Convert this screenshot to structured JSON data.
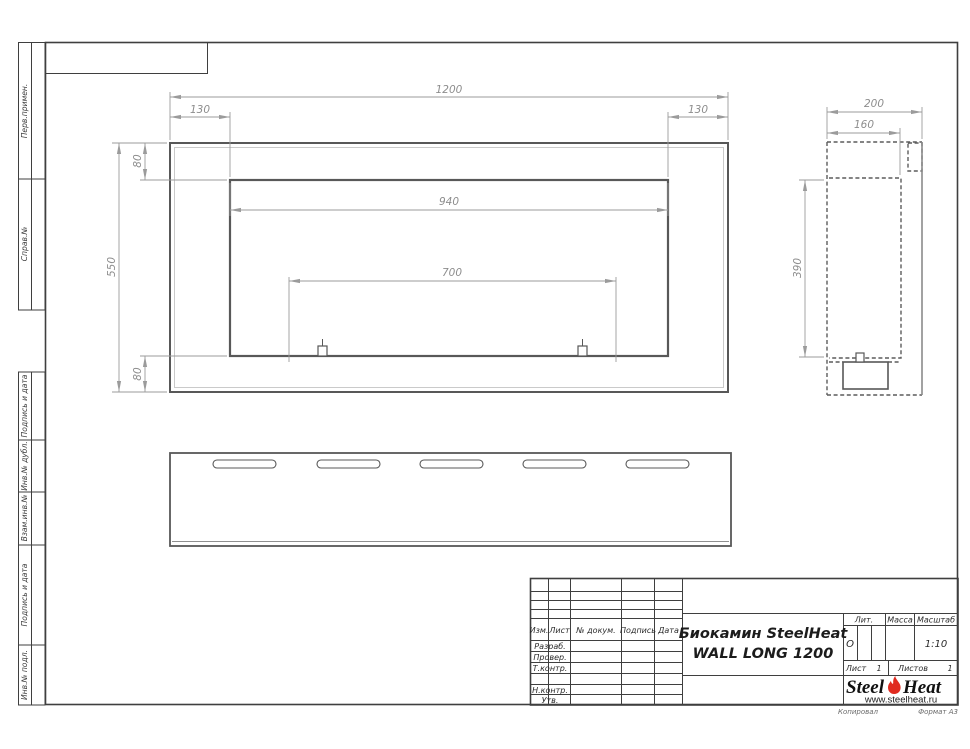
{
  "frame_labels": [
    "Перв.примен.",
    "Справ.№",
    "Подпись и дата",
    "Инв.№ дубл.",
    "Взам.инв.№",
    "Подпись и дата",
    "Инв.№ подл."
  ],
  "title_block": {
    "revision_header": [
      "Изм.",
      "Лист",
      "№ докум.",
      "Подпись",
      "Дата"
    ],
    "signature_rows": [
      "Разраб.",
      "Провер.",
      "Т.контр.",
      "Н.контр.",
      "Утв."
    ],
    "lit_label": "Лит.",
    "lit_value": "О",
    "massa_label": "Масса",
    "scale_label": "Масштаб",
    "scale_value": "1:10",
    "sheet_label": "Лист",
    "sheet_value": "1",
    "sheets_label": "Листов",
    "sheets_value": "1",
    "doc_title_line1": "Биокамин SteelHeat",
    "doc_title_line2": "WALL LONG 1200",
    "logo_steel": "Steel",
    "logo_heat": "Heat",
    "logo_url": "www.steelheat.ru",
    "flame_color": "#e02b20",
    "footer_copied": "Копировал",
    "footer_format": "Формат А3"
  },
  "dimensions": {
    "front": {
      "overall_width": "1200",
      "left_offset": "130",
      "right_offset": "130",
      "top_offset": "80",
      "overall_height": "550",
      "bottom_offset": "80",
      "opening_width": "940",
      "mount_span": "700"
    },
    "side": {
      "depth": "200",
      "inner_depth": "160",
      "inner_height": "390"
    }
  }
}
